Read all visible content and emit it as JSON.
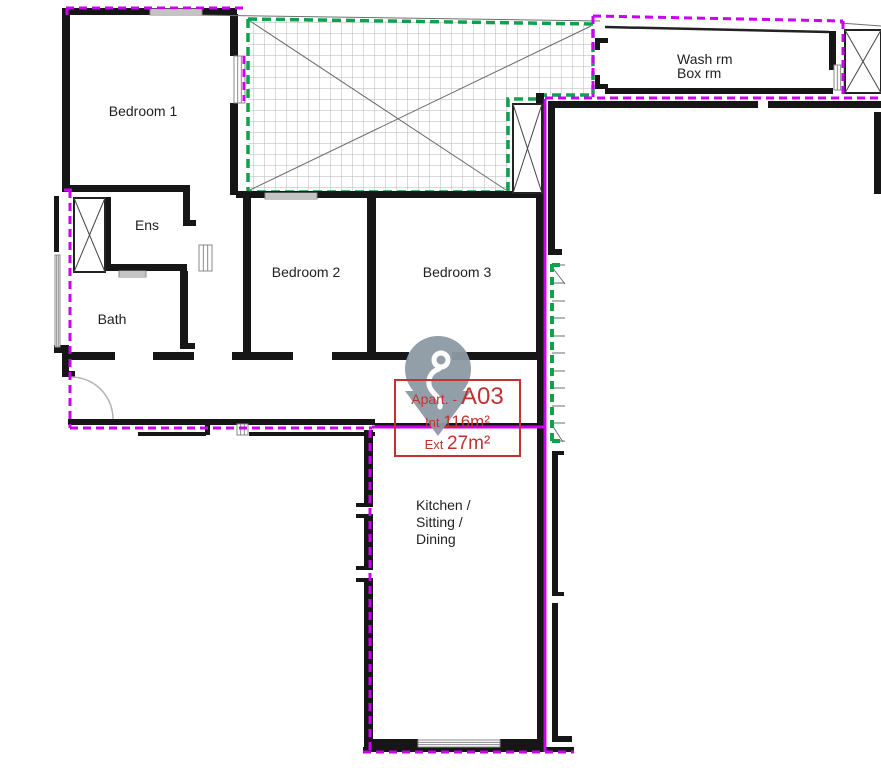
{
  "marker": {
    "prefix": "Apart.",
    "separator": "- ",
    "unit": "A03",
    "int_label": "Int ",
    "int_value": "116m²",
    "ext_label": "Ext ",
    "ext_value": "27m²"
  },
  "rooms": [
    {
      "label": "Bedroom 1",
      "x": 143,
      "y": 111,
      "align": "center"
    },
    {
      "label": "Ens",
      "x": 147,
      "y": 225,
      "align": "center"
    },
    {
      "label": "Bath",
      "x": 112,
      "y": 319,
      "align": "center"
    },
    {
      "label": "Bedroom 2",
      "x": 306,
      "y": 272,
      "align": "center"
    },
    {
      "label": "Bedroom 3",
      "x": 457,
      "y": 272,
      "align": "center"
    },
    {
      "label": "Wash rm",
      "x": 677,
      "y": 59,
      "align": "left"
    },
    {
      "label": "Box rm",
      "x": 677,
      "y": 73,
      "align": "left"
    },
    {
      "label": "Kitchen /",
      "x": 416,
      "y": 505,
      "align": "left"
    },
    {
      "label": "Sitting /",
      "x": 416,
      "y": 522,
      "align": "left"
    },
    {
      "label": "Dining",
      "x": 416,
      "y": 539,
      "align": "left"
    }
  ],
  "colors": {
    "wall": "#161616",
    "window": "#8a8a8a",
    "boundary_purple": "#cb00f2",
    "terrace_green": "#0ea24c",
    "marker_red": "#c43131",
    "pin_gray": "#8e9aa4",
    "hatch_line": "#b5b5b5",
    "thin_line": "#6f6f6f",
    "label_text": "#1f1f1f"
  },
  "geometry": {
    "walls": [
      [
        62,
        8,
        8,
        184
      ],
      [
        62,
        8,
        175,
        7
      ],
      [
        230,
        14,
        8,
        42
      ],
      [
        230,
        103,
        8,
        92
      ],
      [
        68,
        185,
        122,
        7
      ],
      [
        183,
        190,
        7,
        36
      ],
      [
        183,
        220,
        13,
        6
      ],
      [
        104,
        197,
        7,
        74
      ],
      [
        104,
        264,
        83,
        7
      ],
      [
        180,
        271,
        8,
        78
      ],
      [
        180,
        343,
        15,
        6
      ],
      [
        153,
        352,
        41,
        8
      ],
      [
        68,
        352,
        47,
        8
      ],
      [
        62,
        345,
        7,
        32
      ],
      [
        66,
        371,
        9,
        6
      ],
      [
        54,
        196,
        5,
        56
      ],
      [
        54,
        345,
        8,
        8
      ],
      [
        236,
        191,
        309,
        7
      ],
      [
        243,
        198,
        8,
        158
      ],
      [
        367,
        198,
        9,
        158
      ],
      [
        536,
        198,
        9,
        158
      ],
      [
        232,
        352,
        61,
        8
      ],
      [
        332,
        352,
        77,
        8
      ],
      [
        452,
        352,
        93,
        8
      ],
      [
        68,
        419,
        307,
        6
      ],
      [
        375,
        423,
        170,
        3
      ],
      [
        138,
        432,
        68,
        4
      ],
      [
        249,
        432,
        126,
        4
      ],
      [
        205,
        424,
        5,
        11
      ],
      [
        364,
        430,
        9,
        77
      ],
      [
        364,
        514,
        9,
        56
      ],
      [
        364,
        578,
        9,
        167
      ],
      [
        356,
        503,
        9,
        4
      ],
      [
        356,
        514,
        9,
        4
      ],
      [
        356,
        566,
        9,
        4
      ],
      [
        356,
        578,
        9,
        4
      ],
      [
        537,
        356,
        8,
        389
      ],
      [
        364,
        739,
        54,
        8
      ],
      [
        500,
        739,
        45,
        8
      ],
      [
        363,
        747,
        211,
        5
      ],
      [
        552,
        455,
        6,
        141
      ],
      [
        552,
        603,
        6,
        137
      ],
      [
        552,
        451,
        12,
        4
      ],
      [
        552,
        592,
        12,
        4
      ],
      [
        552,
        736,
        20,
        6
      ],
      [
        548,
        101,
        7,
        154
      ],
      [
        548,
        249,
        14,
        6
      ],
      [
        555,
        101,
        203,
        7
      ],
      [
        768,
        101,
        113,
        7
      ],
      [
        874,
        112,
        7,
        82
      ],
      [
        605,
        88,
        228,
        6
      ],
      [
        829,
        31,
        7,
        39
      ],
      [
        595,
        38,
        13,
        5
      ],
      [
        595,
        38,
        5,
        12
      ],
      [
        595,
        75,
        5,
        12
      ],
      [
        595,
        84,
        13,
        5
      ],
      [
        536,
        93,
        8,
        100
      ]
    ],
    "windows": [
      [
        234,
        56,
        11,
        47,
        "v"
      ],
      [
        150,
        9,
        52,
        6,
        "h"
      ],
      [
        265,
        193,
        52,
        6,
        "h"
      ],
      [
        199,
        245,
        13,
        26,
        "v"
      ],
      [
        119,
        271,
        27,
        6,
        "h"
      ],
      [
        55,
        255,
        5,
        92,
        "v"
      ],
      [
        834,
        65,
        10,
        25,
        "v"
      ],
      [
        418,
        740,
        82,
        7,
        "h"
      ],
      [
        237,
        424,
        11,
        11,
        "v"
      ]
    ],
    "shafts": [
      [
        74,
        198,
        31,
        74
      ],
      [
        513,
        104,
        29,
        89
      ],
      [
        845,
        30,
        36,
        63
      ]
    ],
    "terrace": {
      "points": "248,19 593,24 593,95 541,95 541,99 508,99 508,192 248,192",
      "diagonals": [
        [
          250,
          21,
          506,
          190
        ],
        [
          250,
          190,
          591,
          26
        ]
      ]
    },
    "purple_solid": [
      [
        372,
        427,
        546,
        427
      ],
      [
        545,
        100,
        545,
        750
      ]
    ],
    "purple_dashed": [
      [
        66,
        8,
        246,
        8
      ],
      [
        67,
        8,
        67,
        15
      ],
      [
        244,
        56,
        244,
        101
      ],
      [
        70,
        190,
        70,
        428
      ],
      [
        64,
        190,
        75,
        190
      ],
      [
        70,
        428,
        372,
        428
      ],
      [
        370,
        430,
        370,
        752
      ],
      [
        363,
        752,
        574,
        752
      ],
      [
        545,
        99,
        545,
        752
      ],
      [
        545,
        98,
        881,
        98
      ],
      [
        593,
        16,
        593,
        97
      ],
      [
        593,
        16,
        843,
        21
      ],
      [
        843,
        21,
        843,
        97
      ]
    ],
    "green_dashed": [
      [
        552,
        264,
        552,
        443
      ],
      [
        552,
        265,
        562,
        265
      ],
      [
        552,
        441,
        562,
        441
      ]
    ],
    "gray_lines": [
      [
        195,
        15,
        600,
        21
      ],
      [
        840,
        23,
        881,
        26
      ],
      [
        552,
        265,
        565,
        265
      ],
      [
        552,
        283,
        565,
        283
      ],
      [
        552,
        301,
        565,
        301
      ],
      [
        552,
        318,
        565,
        318
      ],
      [
        552,
        336,
        565,
        336
      ],
      [
        552,
        353,
        565,
        353
      ],
      [
        552,
        371,
        565,
        371
      ],
      [
        552,
        388,
        565,
        388
      ],
      [
        552,
        406,
        565,
        406
      ],
      [
        552,
        423,
        565,
        423
      ],
      [
        552,
        441,
        565,
        441
      ],
      [
        552,
        267,
        565,
        284
      ],
      [
        552,
        425,
        563,
        442
      ]
    ],
    "black_lines": [
      [
        605,
        27,
        829,
        32
      ]
    ],
    "door_arc": "M71,377 A42,42 0 0 1 113,419",
    "pin": {
      "circle": [
        438,
        369,
        33
      ],
      "triangle": "405,391 471,391 438,436",
      "glyph_circle": [
        441,
        360,
        7
      ],
      "glyph_tail": "M439,369 C429,372 426,383 432,391 C437,397 441,399 440,407"
    }
  }
}
